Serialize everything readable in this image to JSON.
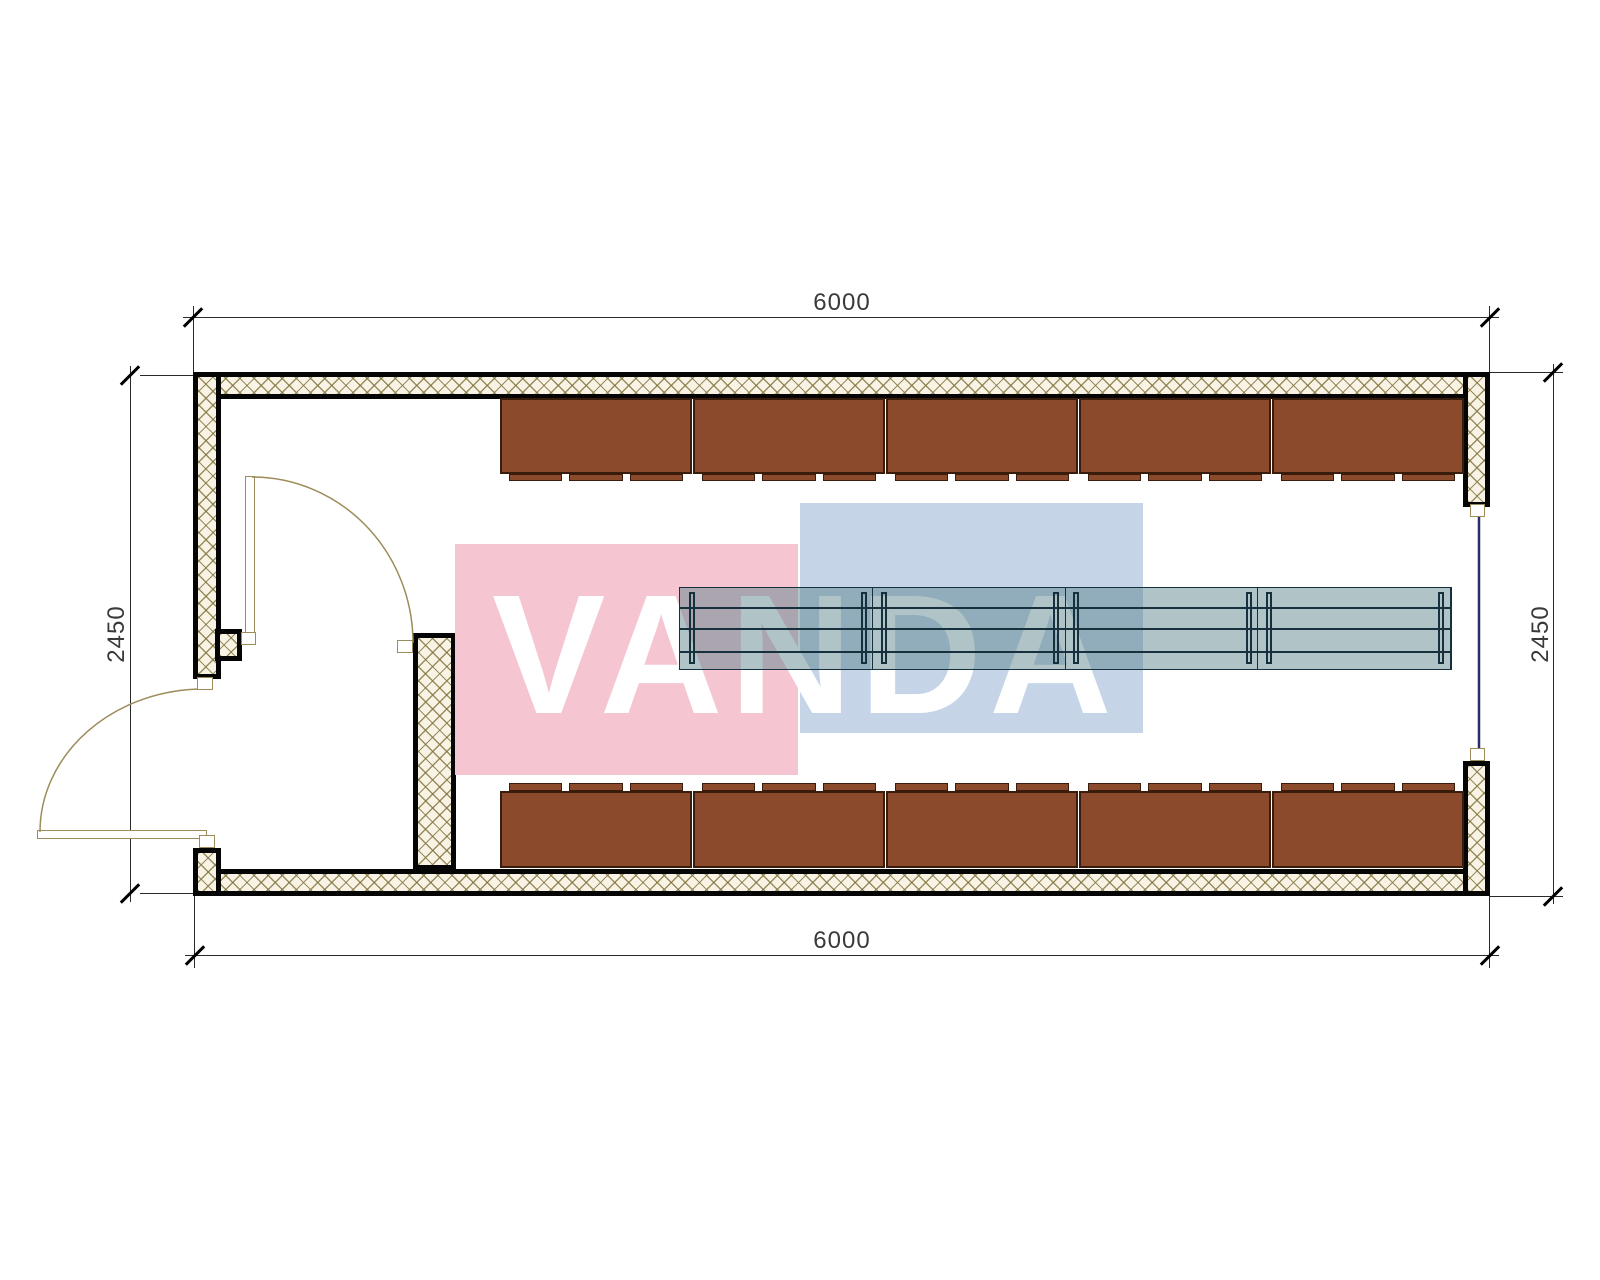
{
  "drawing": {
    "title": "Floor plan of modular container building",
    "dimensions": {
      "top": "6000",
      "bottom": "6000",
      "left": "2450",
      "right": "2450"
    },
    "watermark": {
      "text": "VANDA",
      "red_square_color": "#f5c6d1",
      "blue_square_color": "#c6d4e8",
      "text_color": "#ffffff"
    },
    "cabinets": {
      "top_row_count": 5,
      "bottom_row_count": 5,
      "rail_segments_per_unit": 3
    },
    "table": {
      "sections": 4,
      "plank_lines_offsets": [
        19,
        40,
        63
      ],
      "leg_offsets": [
        9,
        181,
        201,
        373,
        393,
        566,
        586,
        758
      ]
    },
    "openings": {
      "exterior_doors": 1,
      "interior_doors": 1,
      "windows": 1
    },
    "colors": {
      "wall_line": "#050505",
      "hatch_bg": "#f8f3e4",
      "hatch_line": "rgba(128,115,62,0.8)",
      "cabinet_fill": "#8b4a2c",
      "cabinet_border": "#3a1c0d",
      "table_fill": "rgba(80,125,130,0.45)",
      "table_line": "#16303e",
      "door_line": "#9c8c5a",
      "window_line": "#2b2b66",
      "dim_line": "#2a2a2a",
      "dim_text": "#3a3a3a"
    }
  }
}
